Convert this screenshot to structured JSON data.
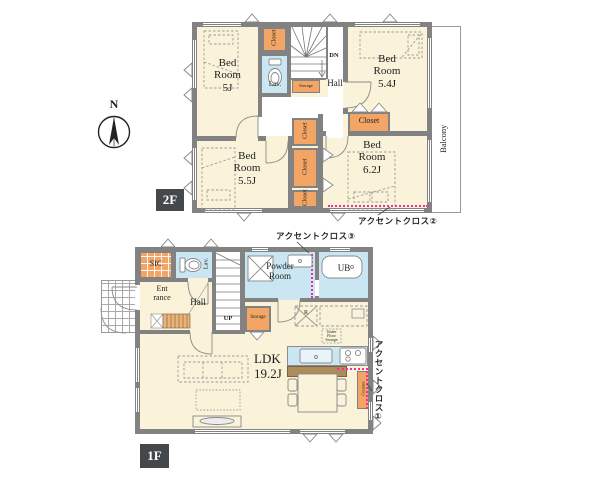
{
  "colors": {
    "wall": "#828282",
    "room": "#FAF3DA",
    "closet": "#F2A564",
    "wet": "#CBE6F3",
    "brown": "#AD8C59",
    "accent_pink": "#F2309B",
    "tag_bg": "#45484B"
  },
  "compass": {
    "north": "N"
  },
  "floor2": {
    "tag": "2F",
    "bedroom_tl": "Bed\nRoom\n5J",
    "bedroom_tr": "Bed\nRoom\n5.4J",
    "bedroom_bl": "Bed\nRoom\n5.5J",
    "bedroom_br": "Bed\nRoom\n6.2J",
    "closet_top": "Closet",
    "closet_right": "Closet",
    "closet_mid_a": "Closet",
    "closet_mid_b": "Closet",
    "closet_mid_c": "Closet",
    "lav": "Lav.",
    "storage": "Storage",
    "hall": "Hall",
    "down": "DN",
    "balcony": "Balcony",
    "accent_note": "アクセントクロス②"
  },
  "floor1": {
    "tag": "1F",
    "sic": "SIC",
    "lav": "Lav.",
    "entrance": "Ent\nrance",
    "hall": "Hall",
    "up": "UP",
    "powder_room": "Powder\nRoom",
    "unit_bath": "UB",
    "storage": "Storage",
    "ldk": "LDK\n19.2J",
    "refrigerator": "R",
    "under_floor_storage": "Under\nFloor\nStorage",
    "counter": "Counter",
    "accent_note_top": "アクセントクロス③",
    "accent_note_right": "アクセントクロス①"
  }
}
